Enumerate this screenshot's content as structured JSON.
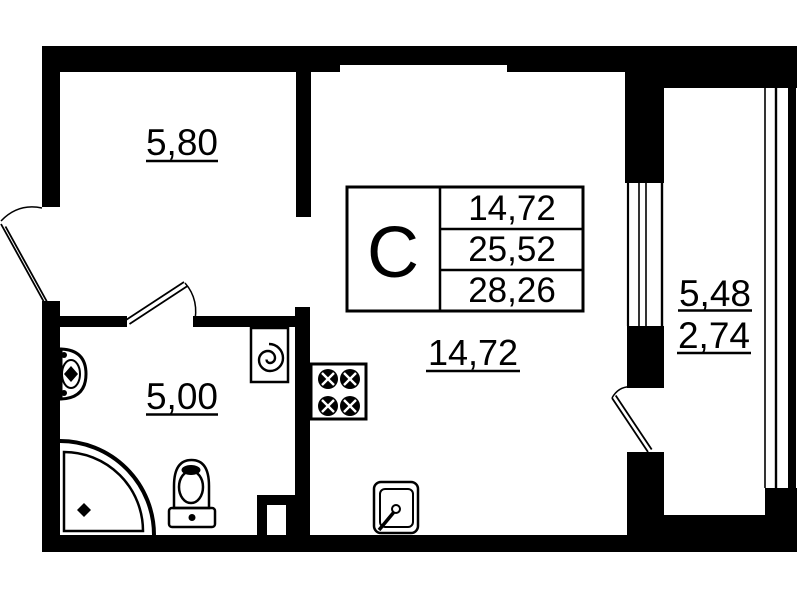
{
  "title": "Studio apartment floor plan",
  "floor_plan": {
    "unit_type_letter": "С",
    "info_table": {
      "living_area": "14,72",
      "apartment_area": "25,52",
      "total_area": "28,26"
    },
    "rooms": {
      "hallway_area": "5,80",
      "bathroom_area": "5,00",
      "living_room_area": "14,72",
      "balcony_area_full": "5,48",
      "balcony_area_reduced": "2,74"
    },
    "colors": {
      "walls": "#000000",
      "fixture_fill": "#d9d9d9",
      "fixture_light_fill": "#ececec",
      "background": "#ffffff"
    }
  }
}
